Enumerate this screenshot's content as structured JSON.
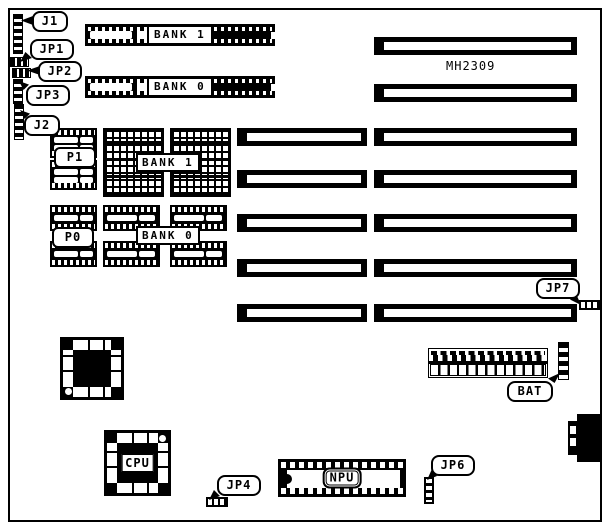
{
  "board": {
    "model": "MH2309"
  },
  "callouts": {
    "j1": "J1",
    "jp1": "JP1",
    "jp2": "JP2",
    "jp3": "JP3",
    "j2": "J2",
    "jp7": "JP7",
    "bat": "BAT",
    "jp4": "JP4",
    "jp6": "JP6"
  },
  "memory": {
    "simm_bank1_label": "BANK 1",
    "simm_bank0_label": "BANK 0",
    "dram_bank1_label": "BANK 1",
    "dram_bank0_label": "BANK 0"
  },
  "chips": {
    "p1": "P1",
    "p0": "P0",
    "cpu": "CPU",
    "npu": "NPU"
  }
}
